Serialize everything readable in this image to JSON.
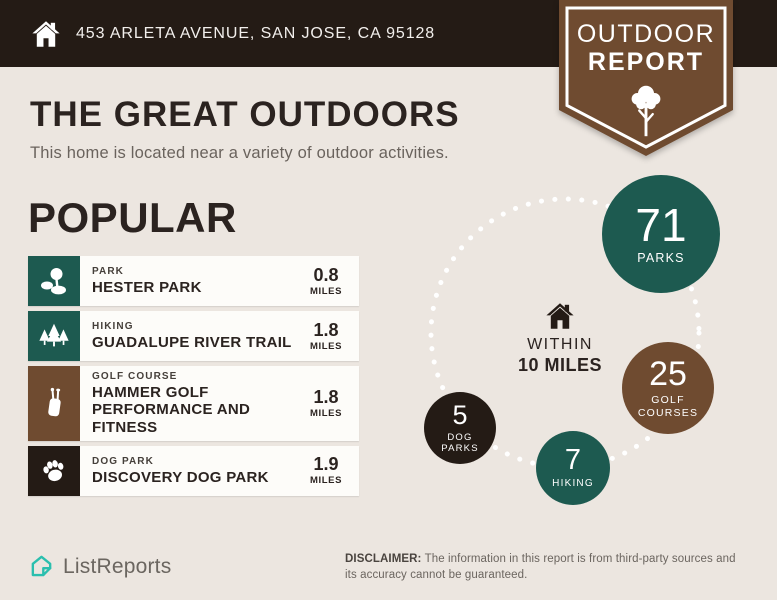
{
  "colors": {
    "background": "#ece6e0",
    "dark_brown": "#241b15",
    "teal": "#1d5a50",
    "brown": "#6f4b30",
    "card_white": "#fdfcf9",
    "logo_teal": "#2bbfae",
    "white": "#ffffff"
  },
  "header": {
    "address": "453 ARLETA AVENUE, SAN JOSE, CA 95128"
  },
  "badge": {
    "line1": "OUTDOOR",
    "line2": "REPORT",
    "icon": "tree-icon"
  },
  "intro": {
    "title": "THE GREAT OUTDOORS",
    "subtitle": "This home is located near a variety of outdoor activities."
  },
  "popular": {
    "heading": "POPULAR",
    "items": [
      {
        "category": "PARK",
        "name": "HESTER PARK",
        "distance": "0.8",
        "unit": "MILES",
        "icon": "park-icon",
        "icon_color": "#1d5a50"
      },
      {
        "category": "HIKING",
        "name": "GUADALUPE RIVER TRAIL",
        "distance": "1.8",
        "unit": "MILES",
        "icon": "hiking-icon",
        "icon_color": "#1d5a50"
      },
      {
        "category": "GOLF COURSE",
        "name": "HAMMER GOLF PERFORMANCE AND FITNESS",
        "distance": "1.8",
        "unit": "MILES",
        "icon": "golf-icon",
        "icon_color": "#6f4b30"
      },
      {
        "category": "DOG PARK",
        "name": "DISCOVERY DOG PARK",
        "distance": "1.9",
        "unit": "MILES",
        "icon": "paw-icon",
        "icon_color": "#241b15"
      }
    ]
  },
  "radius": {
    "line1": "WITHIN",
    "line2": "10 MILES",
    "icon": "house-icon"
  },
  "stats": [
    {
      "value": "71",
      "label": "PARKS",
      "color": "#1d5a50"
    },
    {
      "value": "25",
      "label": "GOLF COURSES",
      "color": "#6f4b30"
    },
    {
      "value": "5",
      "label": "DOG PARKS",
      "color": "#241b15"
    },
    {
      "value": "7",
      "label": "HIKING",
      "color": "#1d5a50"
    }
  ],
  "chart_data": {
    "type": "bar",
    "title": "Outdoor activities within 10 miles",
    "categories": [
      "Parks",
      "Golf Courses",
      "Dog Parks",
      "Hiking"
    ],
    "values": [
      71,
      25,
      5,
      7
    ]
  },
  "footer": {
    "brand": "ListReports",
    "disclaimer_label": "DISCLAIMER:",
    "disclaimer_text": " The information in this report is from third-party sources and its accuracy cannot be guaranteed."
  }
}
